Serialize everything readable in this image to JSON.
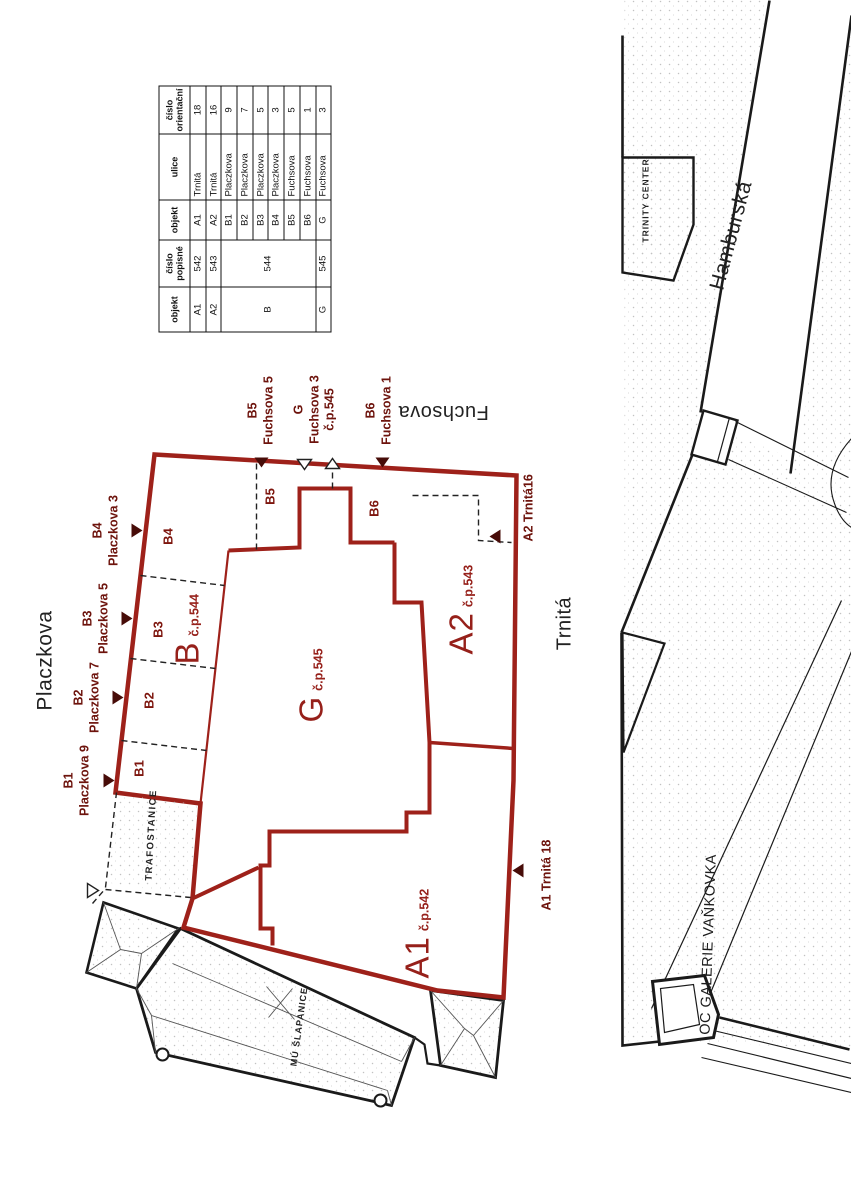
{
  "title": "site plan – Trnitá / Placzkova / Fuchsova block",
  "streets": {
    "placzkova": "Placzkova",
    "fuchsova": "Fuchsova",
    "trnita": "Trnitá",
    "hamburska": "Hamburská"
  },
  "landmarks": {
    "trinity_center": "TRINITY CENTER",
    "galerie_vankovka": "OC GALERIE VAŇKOVKA",
    "mu_slapanice": "MÚ ŠLAPANICE",
    "trafostanice": "TRAFOSTANICE"
  },
  "parcels": {
    "b1": "B1",
    "b2": "B2",
    "b3": "B3",
    "b4": "B4",
    "b5": "B5",
    "b6": "B6",
    "buildings": [
      {
        "letter": "B",
        "cp": "č.p.544"
      },
      {
        "letter": "G",
        "cp": "č.p.545"
      },
      {
        "letter": "A1",
        "cp": "č.p.542"
      },
      {
        "letter": "A2",
        "cp": "č.p.543"
      }
    ]
  },
  "markers": {
    "b1": {
      "lines": [
        "B1",
        "Placzkova 9"
      ]
    },
    "b2": {
      "lines": [
        "B2",
        "Placzkova 7"
      ]
    },
    "b3": {
      "lines": [
        "B3",
        "Placzkova 5"
      ]
    },
    "b4": {
      "lines": [
        "B4",
        "Placzkova 3"
      ]
    },
    "b5": {
      "lines": [
        "B5",
        "Fuchsova 5"
      ]
    },
    "g": {
      "lines": [
        "G",
        "Fuchsova 3",
        "č.p.545"
      ]
    },
    "b6": {
      "lines": [
        "B6",
        "Fuchsova 1"
      ]
    },
    "a1": {
      "lines": [
        "A1 Trnitá 18"
      ]
    },
    "a2": {
      "lines": [
        "A2 Trnitá16"
      ]
    }
  },
  "table": {
    "headers": [
      "objekt",
      "číslo popisné",
      "objekt",
      "ulice",
      "číslo orientační"
    ],
    "rows": [
      {
        "objekt": "A1",
        "cp": "542",
        "obj2": "A1",
        "ulice": "Trnitá",
        "co": "18"
      },
      {
        "objekt": "A2",
        "cp": "543",
        "obj2": "A2",
        "ulice": "Trnitá",
        "co": "16"
      },
      {
        "objekt": "B",
        "cp": "544",
        "obj2": "B1",
        "ulice": "Placzkova",
        "co": "9"
      },
      {
        "obj2": "B2",
        "ulice": "Placzkova",
        "co": "7"
      },
      {
        "obj2": "B3",
        "ulice": "Placzkova",
        "co": "5"
      },
      {
        "obj2": "B4",
        "ulice": "Placzkova",
        "co": "3"
      },
      {
        "obj2": "B5",
        "ulice": "Fuchsova",
        "co": "5"
      },
      {
        "obj2": "B6",
        "ulice": "Fuchsova",
        "co": "1"
      },
      {
        "objekt": "G",
        "cp": "545",
        "obj2": "G",
        "ulice": "Fuchsova",
        "co": "3"
      }
    ]
  },
  "colors": {
    "red_line": "#9e211a",
    "red_text": "#96201a",
    "marker_dark": "#470c08",
    "line_black": "#1a1a1a"
  }
}
